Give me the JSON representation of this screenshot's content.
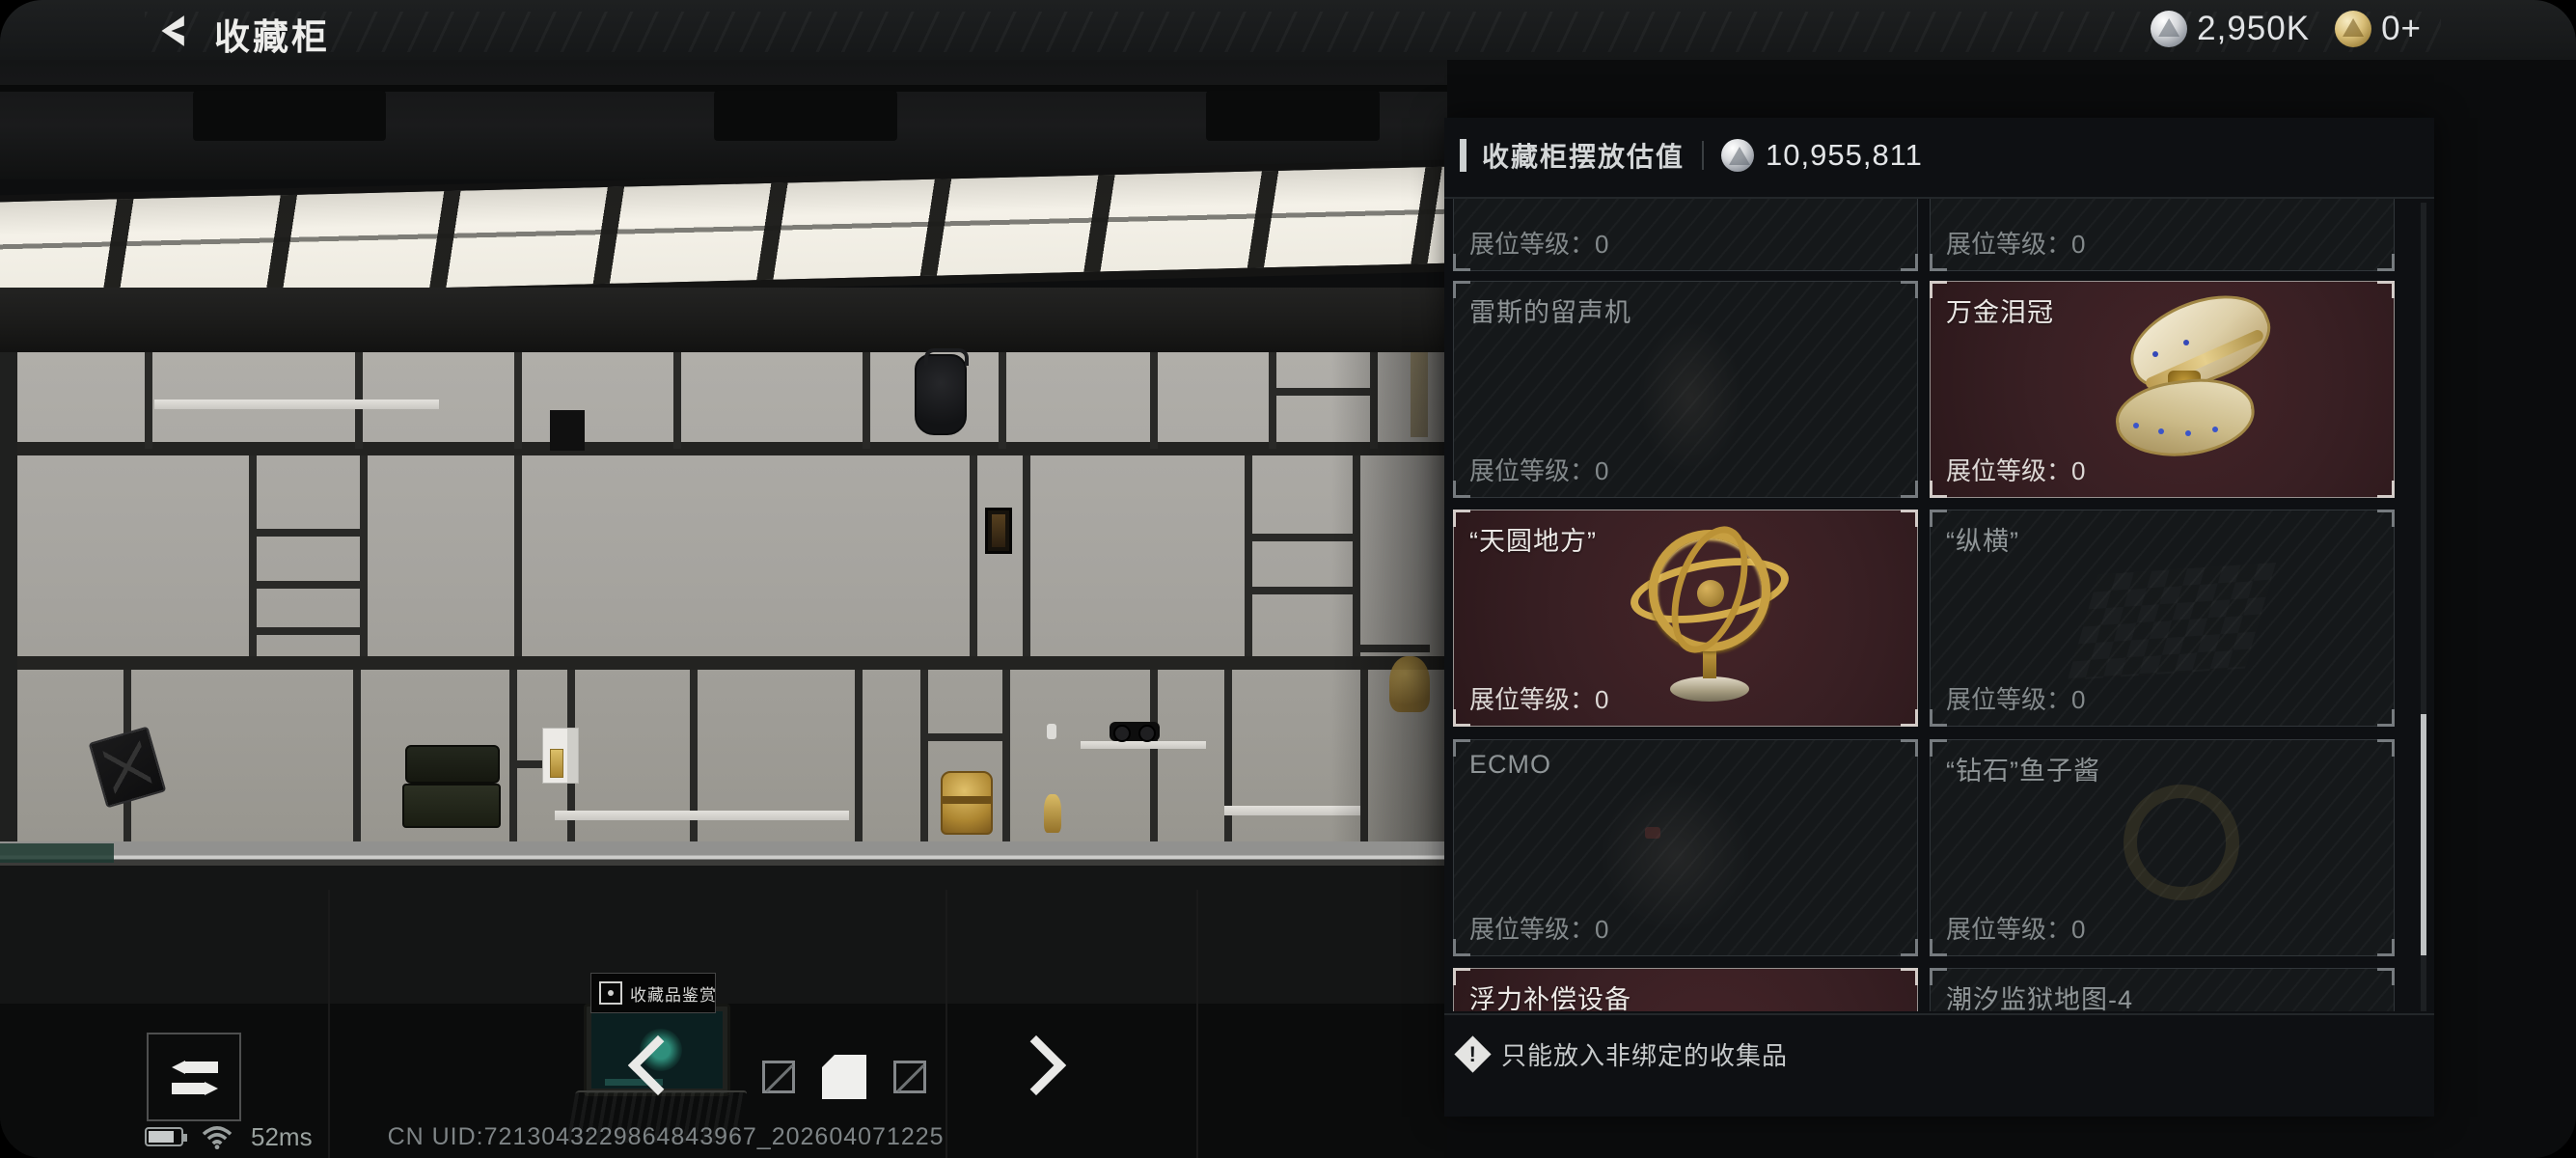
{
  "header": {
    "title": "收藏柜",
    "currencies": [
      {
        "icon": "silver-coin",
        "value": "2,950K"
      },
      {
        "icon": "gold-coin",
        "value": "0+"
      }
    ]
  },
  "panel": {
    "title": "收藏柜摆放估值",
    "value_icon": "silver-coin",
    "value": "10,955,811",
    "level_label": "展位等级：",
    "cards": [
      {
        "name": "",
        "level": "0",
        "state": "dim",
        "image": "none"
      },
      {
        "name": "",
        "level": "0",
        "state": "dim",
        "image": "none"
      },
      {
        "name": "雷斯的留声机",
        "level": "0",
        "state": "dim",
        "image": "phonograph"
      },
      {
        "name": "万金泪冠",
        "level": "0",
        "state": "highlight",
        "image": "jeweled-crown-box"
      },
      {
        "name": "“天圆地方”",
        "level": "0",
        "state": "highlight",
        "image": "armillary-sphere"
      },
      {
        "name": "“纵横”",
        "level": "0",
        "state": "dim",
        "image": "chessboard"
      },
      {
        "name": "ECMO",
        "level": "0",
        "state": "dim",
        "image": "ecmo-machine"
      },
      {
        "name": "“钻石”鱼子酱",
        "level": "0",
        "state": "dim",
        "image": "caviar-tin"
      },
      {
        "name": "浮力补偿设备",
        "level": "0",
        "state": "highlight",
        "image": "buoyancy-device"
      },
      {
        "name": "潮汐监狱地图-4",
        "level": "0",
        "state": "dim",
        "image": "tide-prison-map"
      }
    ],
    "notice": "只能放入非绑定的收集品"
  },
  "scene": {
    "terminal_label": "收藏品鉴赏"
  },
  "footer": {
    "ping": "52ms",
    "uid": "CN UID:7213043229864843967_202604071225"
  },
  "icons": {
    "back": "back-chevron",
    "silver": "silver-coin",
    "gold": "gold-coin",
    "alert": "alert-diamond",
    "swap": "swap-arrows"
  },
  "colors": {
    "highlight_card_bg": "#381f23",
    "panel_bg": "#0e1013",
    "skylight": "#f4f1e8",
    "wall": "#a6a49f"
  }
}
